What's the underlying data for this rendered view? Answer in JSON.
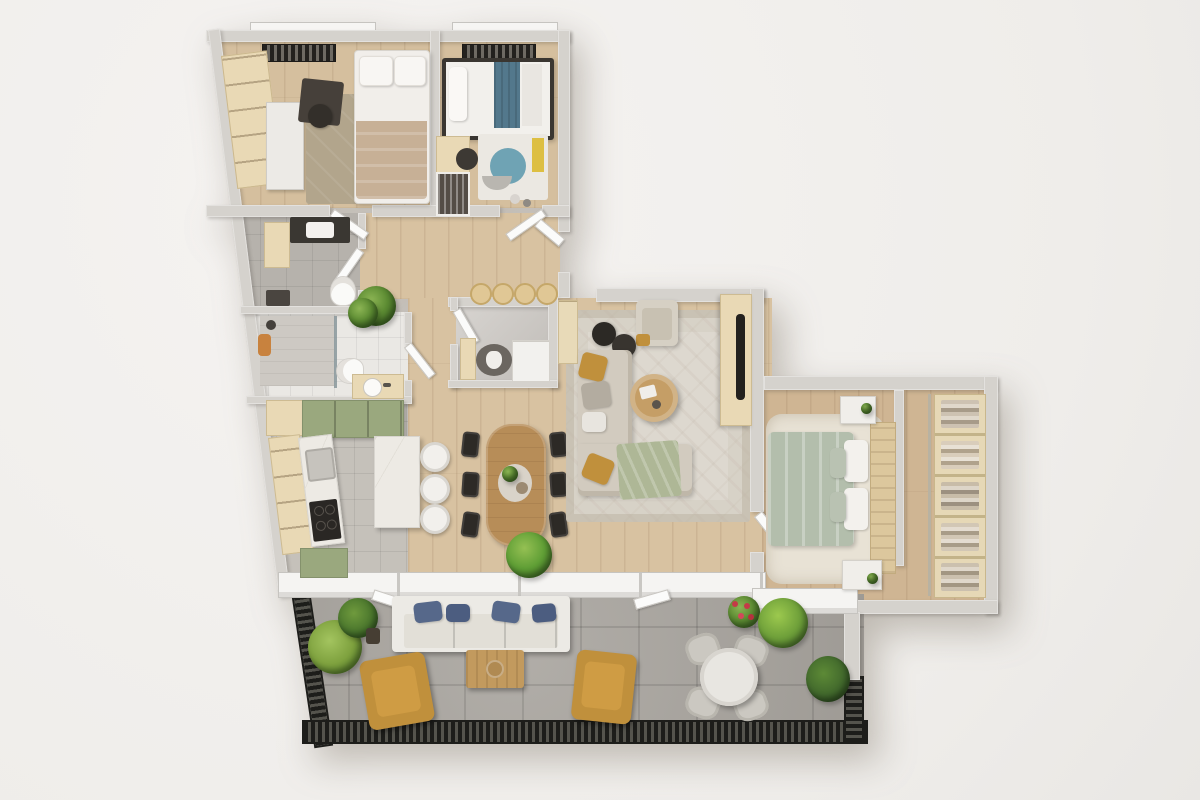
{
  "scene": {
    "type": "apartment-floor-plan-3d-render",
    "view": "top-down-orthographic",
    "style": "photorealistic render, no text labels visible",
    "background_color": "#f1efec"
  },
  "palette": {
    "walls": "#d5d2cd",
    "wood_floor": "#d8c2a1",
    "gray_tile": "#c5c1ba",
    "white_tile": "#eae8e4",
    "balcony_concrete": "#a8a49e",
    "railing_black": "#1d1d1a",
    "cabinet_cream": "#e9d9b5",
    "cabinet_sage_green": "#9aa87e",
    "marble_counter": "#edeae4",
    "sofa_beige": "#d2cbbf",
    "accent_mustard": "#c0903c",
    "bedding_sage": "#b3beac",
    "bedding_teal": "#53788c",
    "outdoor_pillow_blue": "#56688a",
    "plant_green": "#5d8c33",
    "dining_table_wood": "#b78d58"
  },
  "rooms": [
    {
      "id": "bedroom-1",
      "type": "bedroom",
      "floor": "wood",
      "furniture": [
        "built-in-cream-wardrobe",
        "white-sliding-wardrobe",
        "dark-desk",
        "desk-chair",
        "taupe-area-rug",
        "double-bed-beige-blanket",
        "window-bay-with-radiator"
      ]
    },
    {
      "id": "bedroom-2",
      "type": "kids-bedroom",
      "floor": "wood",
      "furniture": [
        "single-bed-teal-blanket-dark-frame",
        "cream-desk",
        "desk-chair",
        "play-rug-teal-circle-yellow",
        "open-wardrobe",
        "toys",
        "window-bay-with-radiator"
      ]
    },
    {
      "id": "hallway",
      "type": "entry-hall",
      "floor": "wood",
      "furniture": [
        "potted-plant",
        "row-of-four-stools",
        "entry-door"
      ]
    },
    {
      "id": "wc",
      "type": "guest-toilet",
      "floor": "gray-tile",
      "furniture": [
        "dark-vanity-with-sink",
        "cream-base-cabinet",
        "toilet",
        "dark-floor-mat",
        "door"
      ]
    },
    {
      "id": "bathroom",
      "type": "bathroom",
      "floor": "white-tile",
      "furniture": [
        "walk-in-shower-glass-screen",
        "toilet",
        "cream-vanity-round-sink",
        "orange-towel",
        "potted-plant",
        "door"
      ]
    },
    {
      "id": "utility-room",
      "type": "utility-room",
      "floor": "stone-tile",
      "furniture": [
        "white-drawer-unit",
        "gray-pet-bed",
        "cream-bench",
        "door"
      ]
    },
    {
      "id": "kitchen",
      "type": "kitchen",
      "floor": "gray-tile",
      "furniture": [
        "sage-upper-cabinet-row",
        "cream-open-shelving",
        "marble-counter-with-sink",
        "black-cooktop",
        "marble-island",
        "white-bar-stools-x3",
        "sage-base-cabinet"
      ]
    },
    {
      "id": "dining-area",
      "type": "dining-area",
      "floor": "wood",
      "furniture": [
        "oval-wood-table",
        "black-dining-chairs-x6",
        "table-centerpiece",
        "windowsill-plant"
      ]
    },
    {
      "id": "living-room",
      "type": "living-room",
      "floor": "wood",
      "furniture": [
        "patterned-light-rug",
        "l-shaped-beige-sofa",
        "mustard-pillows",
        "gray-pillows",
        "sage-green-throw",
        "round-wood-coffee-table",
        "beige-armchair",
        "dark-poufs-x2",
        "cream-tv-sideboard",
        "wall-mounted-tv",
        "cream-ladder-shelf",
        "door-to-master-bedroom"
      ]
    },
    {
      "id": "master-bedroom",
      "type": "master-bedroom",
      "floor": "wood",
      "furniture": [
        "double-bed-sage-bedding",
        "wood-headboard-panel",
        "white-nightstands-x2",
        "fluffy-cream-rug",
        "radiator",
        "balcony-window"
      ]
    },
    {
      "id": "walk-in-closet",
      "type": "walk-in-closet",
      "floor": "wood",
      "furniture": [
        "shelving-unit-folded-clothes",
        "glass-partition"
      ]
    },
    {
      "id": "balcony",
      "type": "balcony-terrace",
      "floor": "concrete-tile",
      "furniture": [
        "white-outdoor-sofa-blue-pillows",
        "wood-coffee-table",
        "mustard-armchairs-x2",
        "round-white-table",
        "outdoor-chairs-x4",
        "potted-plants-x6",
        "black-metal-railing"
      ]
    }
  ]
}
